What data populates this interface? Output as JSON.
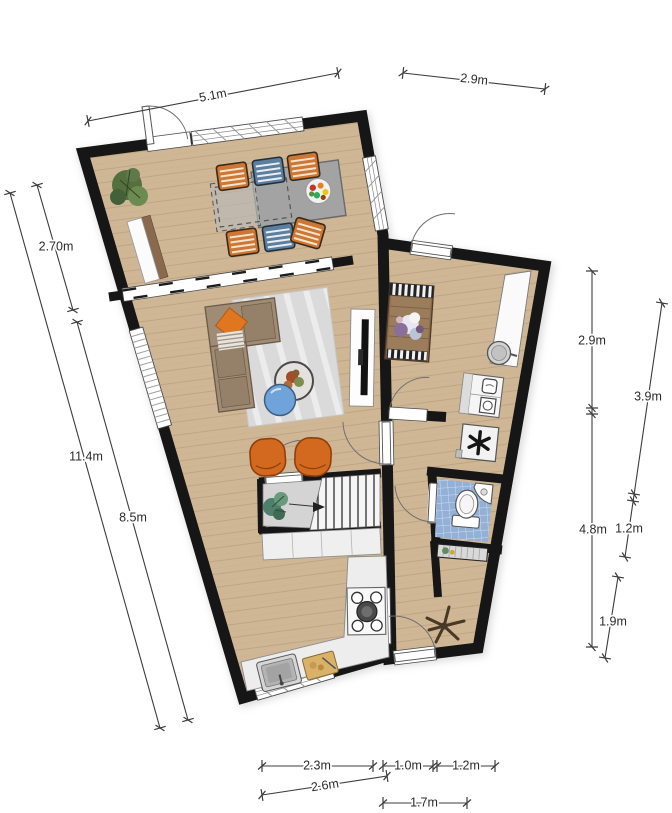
{
  "title": "apartment-floorplan",
  "dimensions": {
    "top_main": "5.1m",
    "top_annex": "2.9m",
    "left_upper": "2.70m",
    "left_total": "11.4m",
    "left_lower": "8.5m",
    "right_upper": "2.9m",
    "right_lower": "4.8m",
    "annex_upper": "3.9m",
    "annex_mid": "1.2m",
    "annex_lower": "1.9m",
    "bottom_a": "2.3m",
    "bottom_b": "1.0m",
    "bottom_c": "1.2m",
    "bottom_d": "2.6m",
    "bottom_e": "1.7m"
  },
  "icons": {
    "ventilation-unit": "asterisk",
    "stairs-direction": "arrow",
    "starfish-decor": "star-plant"
  },
  "colors": {
    "wall": "#161616",
    "wood_floor": "#cfb795",
    "wood_line": "#b69c7b",
    "tile_blue": "#93b1d6",
    "rug_gray": "#dadada",
    "accent_orange": "#d2691e",
    "sofa_taupe": "#a08c74",
    "table_blue": "#6fa3d9",
    "landing_gray": "#d4d4d4",
    "counter_white": "#ededed"
  }
}
